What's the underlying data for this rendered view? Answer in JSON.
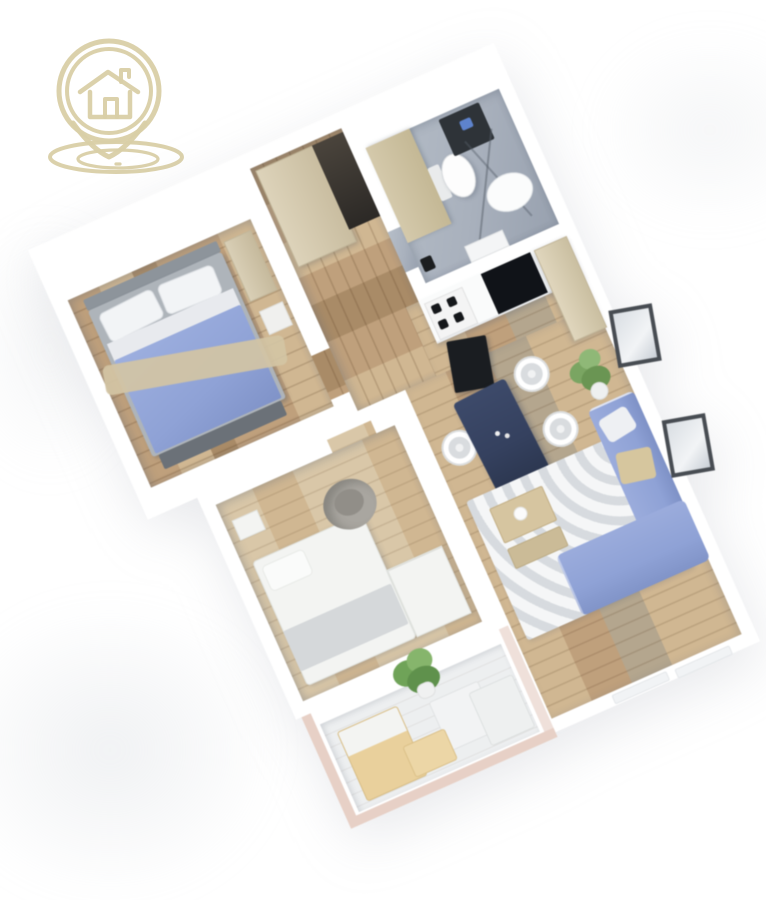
{
  "scene": {
    "type": "3d-floor-plan-render",
    "description": "Isometric 3D rendering of an apartment floor plan, rotated, on a white background with a real-estate logo in the top-left corner",
    "rotation_deg": -24
  },
  "logo": {
    "icon": "house-location-pin-icon",
    "parts": [
      "map-pin-outline",
      "double-ring",
      "house-with-chimney",
      "ground-ellipses"
    ]
  },
  "colors": {
    "bg": "#ffffff",
    "wall": "#ffffff",
    "logo": "#d9cfa6",
    "wood": "#bfa07c",
    "wood-dark": "#a98b67",
    "wood-light": "#d0b792",
    "wood-gray": "#b4a68e",
    "wood-pale": "#d9c7a8",
    "tile": "#a9b1bd",
    "beige": "#d9cfb6",
    "blanket": "#8fa2d6",
    "sofa": "#8fa2d6",
    "cushion": "#d6c69e",
    "table-navy": "#35415f",
    "dark-appliance": "#1a1d21",
    "plant": "#76a35e",
    "deck": "#edeff0",
    "railing": "#e7d0c6",
    "bed-frame": "#aeb4ba",
    "white-furniture": "#f3f4f2",
    "rug": "#f5f6f7",
    "rug-stripe": "#a0a8b2",
    "frame-border": "#474c52"
  },
  "rooms": [
    {
      "name": "bedroom",
      "floor": "wood",
      "furniture": [
        "double-bed",
        "pillows",
        "blue-duvet",
        "throw-blanket",
        "foot-bench",
        "beige-dresser",
        "nightstand"
      ]
    },
    {
      "name": "hallway",
      "floor": "wood",
      "furniture": [
        "wardrobe",
        "entry-doorway"
      ]
    },
    {
      "name": "bathroom",
      "floor": "gray-tile",
      "furniture": [
        "toilet",
        "shower-glass",
        "shower-tray",
        "washing-machine",
        "sink",
        "waste-bin"
      ]
    },
    {
      "name": "kitchen",
      "floor": "wood",
      "furniture": [
        "counter",
        "cooktop",
        "black-counter-unit",
        "oven-unit",
        "tall-cabinet"
      ]
    },
    {
      "name": "dining-area",
      "floor": "wood",
      "furniture": [
        "navy-dining-table",
        "chair",
        "chair",
        "chair",
        "chair"
      ]
    },
    {
      "name": "living-room",
      "floor": "wood",
      "furniture": [
        "striped-rug",
        "coffee-table",
        "corner-sofa",
        "beige-pillow",
        "white-pillow",
        "potted-plant",
        "wall-frame",
        "wall-frame"
      ]
    },
    {
      "name": "second-room",
      "floor": "wood",
      "furniture": [
        "single-bed",
        "gray-armchair",
        "dresser"
      ]
    },
    {
      "name": "balcony",
      "floor": "deck",
      "furniture": [
        "potted-plant",
        "wood-lounge-chair",
        "white-chair",
        "side-table",
        "white-lounger",
        "railing"
      ]
    }
  ]
}
